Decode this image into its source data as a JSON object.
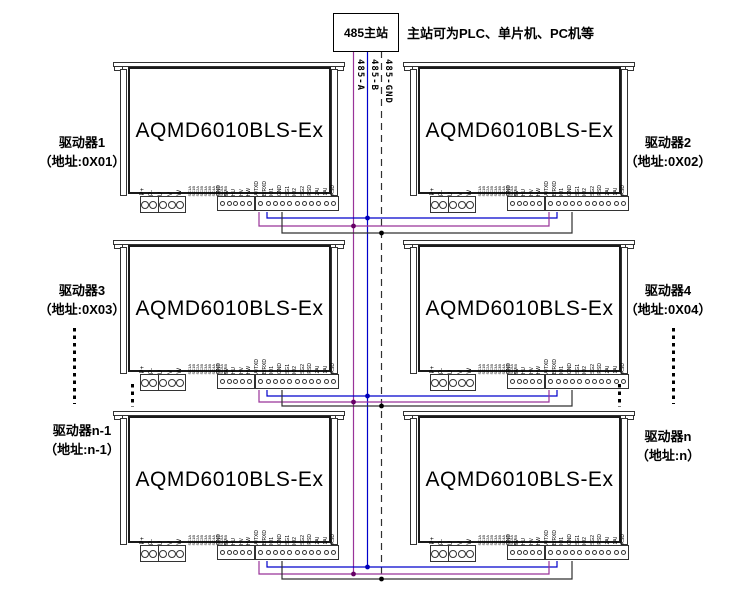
{
  "master": {
    "label": "485主站",
    "note": "主站可为PLC、单片机、PC机等"
  },
  "bus": {
    "lines": [
      {
        "label": "485-A",
        "color": "#993399",
        "style": "solid"
      },
      {
        "label": "485-B",
        "color": "#0000cc",
        "style": "solid"
      },
      {
        "label": "485-GND",
        "color": "#303030",
        "style": "dashed"
      }
    ]
  },
  "colors": {
    "bus_a": "#993399",
    "bus_b": "#0000cc",
    "bus_gnd": "#303030",
    "junction_a": "#660066",
    "junction_b": "#0000bb",
    "junction_gnd": "#000000",
    "outline": "#333333"
  },
  "drivers": [
    {
      "model": "AQMD6010BLS-Ex",
      "name": "驱动器1",
      "address": "（地址:0X01）"
    },
    {
      "model": "AQMD6010BLS-Ex",
      "name": "驱动器2",
      "address": "（地址:0X02）"
    },
    {
      "model": "AQMD6010BLS-Ex",
      "name": "驱动器3",
      "address": "（地址:0X03）"
    },
    {
      "model": "AQMD6010BLS-Ex",
      "name": "驱动器4",
      "address": "（地址:0X04）"
    },
    {
      "model": "AQMD6010BLS-Ex",
      "name": "驱动器n-1",
      "address": "（地址:n-1）"
    },
    {
      "model": "AQMD6010BLS-Ex",
      "name": "驱动器n",
      "address": "（地址:n）"
    }
  ],
  "terminals": {
    "power": [
      "P+",
      "P-",
      "U",
      "V",
      "W"
    ],
    "config": [
      "SC1A",
      "SC1B",
      "SC2A",
      "SC2B",
      "SC3A",
      "SC3B",
      "SC4A",
      "SC4B",
      "SC5A",
      "SC5B"
    ],
    "hall": [
      "GND",
      "5V",
      "HU",
      "HV",
      "HW"
    ],
    "signal": [
      "A/TXD",
      "B/RXD",
      "IO1",
      "GND",
      "SG1",
      "IO2",
      "SG2",
      "RSD",
      "2AI",
      "1AI",
      "RSD"
    ]
  }
}
